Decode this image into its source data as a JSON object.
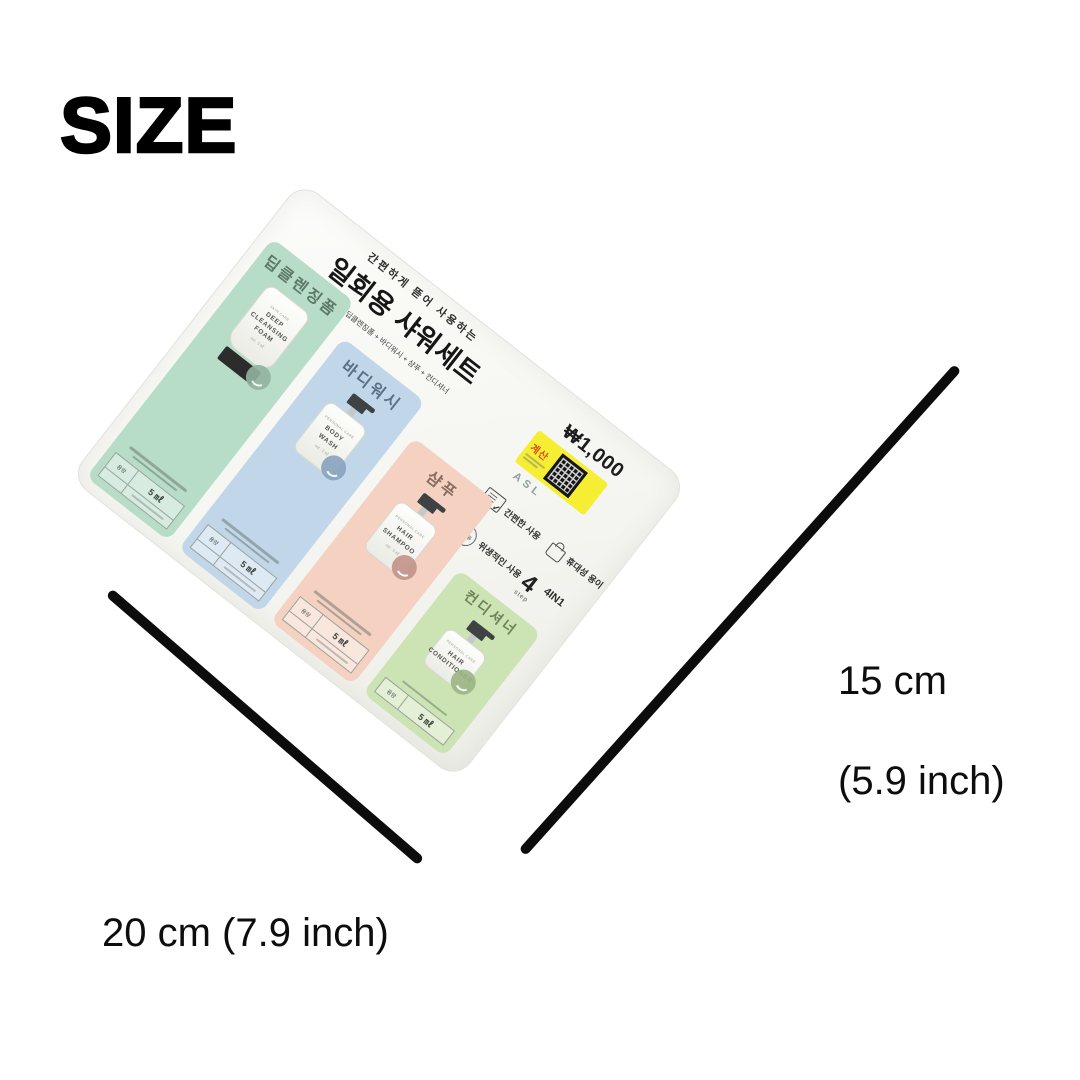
{
  "page": {
    "title": "SIZE",
    "background": "#ffffff"
  },
  "dimensions": {
    "height": {
      "value": "15 cm",
      "inches": "(5.9 inch)"
    },
    "width": {
      "value": "20 cm (7.9 inch)"
    },
    "line_color": "#0c0c0c"
  },
  "package": {
    "tagline": "간편하게 뜯어 사용하는",
    "title": "일회용 샤워세트",
    "type_badge": "4종",
    "subtitle": "딥클렌징폼 + 바디워시 + 샴푸 + 컨디셔너",
    "price": "₩1,000",
    "checkout_label": "계산",
    "checkout_bg": "#f6ee33",
    "brand": "ASL",
    "features": [
      {
        "icon": "checklist-icon",
        "label": "간편한 사용"
      },
      {
        "icon": "disposable-circle-icon",
        "circle_text": "일회용",
        "label": "위생적인 사용"
      },
      {
        "icon": "bag-icon",
        "label": "휴대성 용이"
      }
    ],
    "step": {
      "number": "4",
      "unit": "step",
      "formula": "4IN1"
    },
    "sachets": [
      {
        "label": "딥클렌징폼",
        "brand": "SKIN CARE",
        "product": "DEEP\nCLEANSING\nFOAM",
        "net": "net . 5 ㎖",
        "volume_label": "용량",
        "volume": "5 ㎖",
        "container": "tube",
        "color": "#b7dcc7",
        "label_color": "#5d7a68",
        "badge_color": "#93b3a0"
      },
      {
        "label": "바디워시",
        "brand": "PERSONAL CARE",
        "product": "BODY\nWASH",
        "net": "net . 5 ㎖",
        "volume_label": "용량",
        "volume": "5 ㎖",
        "container": "pump",
        "color": "#c1d7e9",
        "label_color": "#5d6f85",
        "badge_color": "#89a3bd"
      },
      {
        "label": "샴푸",
        "brand": "PERSONAL CARE",
        "product": "HAIR\nSHAMPOO",
        "net": "net . 5 ㎖",
        "volume_label": "용량",
        "volume": "5 ㎖",
        "container": "pump",
        "color": "#f4d1c1",
        "label_color": "#8a6b60",
        "badge_color": "#c2938a"
      },
      {
        "label": "컨디셔너",
        "brand": "PERSONAL CARE",
        "product": "HAIR\nCONDITIONER",
        "net": "net . 5 ㎖",
        "volume_label": "용량",
        "volume": "5 ㎖",
        "container": "pump",
        "color": "#cce3b4",
        "label_color": "#6e8257",
        "badge_color": "#9cb585"
      }
    ]
  }
}
